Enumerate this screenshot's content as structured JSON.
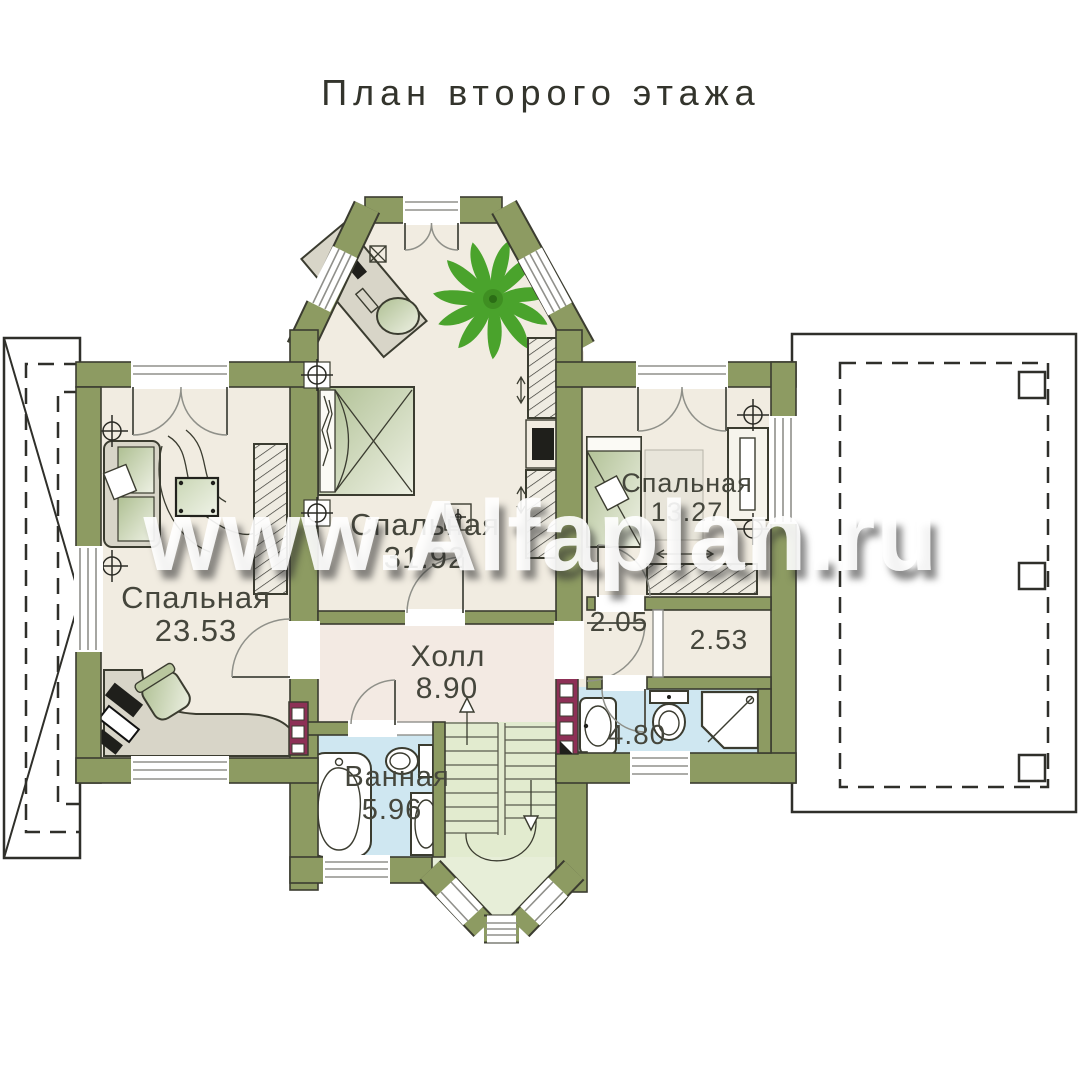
{
  "title": "План второго этажа",
  "watermark": "www.Alfaplan.ru",
  "rooms": [
    {
      "name": "Спальная",
      "area": "23.53"
    },
    {
      "name": "Спальная",
      "area": "31.92"
    },
    {
      "name": "Спальная",
      "area": "13.27"
    },
    {
      "name": "Холл",
      "area": "8.90"
    },
    {
      "name": "Ванная",
      "area": "5.96"
    },
    {
      "name": "",
      "area": "2.05"
    },
    {
      "name": "",
      "area": "2.53"
    },
    {
      "name": "",
      "area": "4.80"
    }
  ],
  "colors": {
    "wall": "#8d9b62",
    "line": "#3b3c30",
    "floor": "#f1ece1",
    "floorHall": "#f3eae3",
    "floorBath": "#cfe7f1",
    "floorStair": "#e2ebcf",
    "floorBay": "#e7eed8",
    "vent": "#8d3056",
    "ventLight": "#eec2d1",
    "plant": "#4aa32c",
    "furn": "#d8d5c8",
    "outline": "#2f2f2a"
  }
}
